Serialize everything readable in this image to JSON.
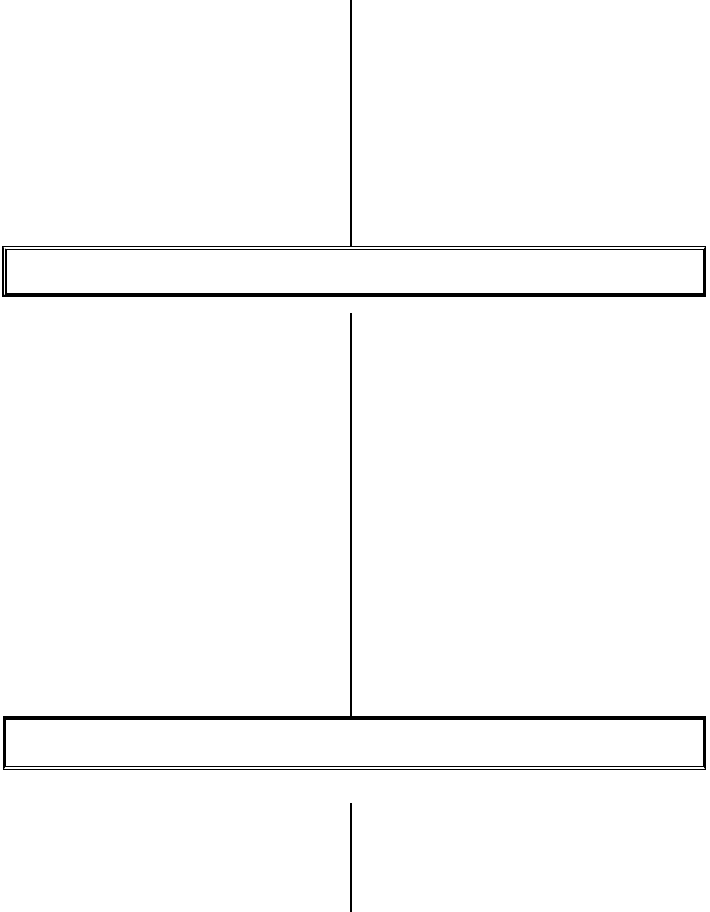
{
  "page": {
    "description": "Blank scanned flowchart template: vertical connector, wide empty box, vertical connector, wide empty box, vertical connector",
    "background_color": "#ffffff",
    "line_color": "#000000"
  },
  "diagram": {
    "upper_box": {
      "label": ""
    },
    "lower_box": {
      "label": ""
    },
    "connector_count": 3
  }
}
